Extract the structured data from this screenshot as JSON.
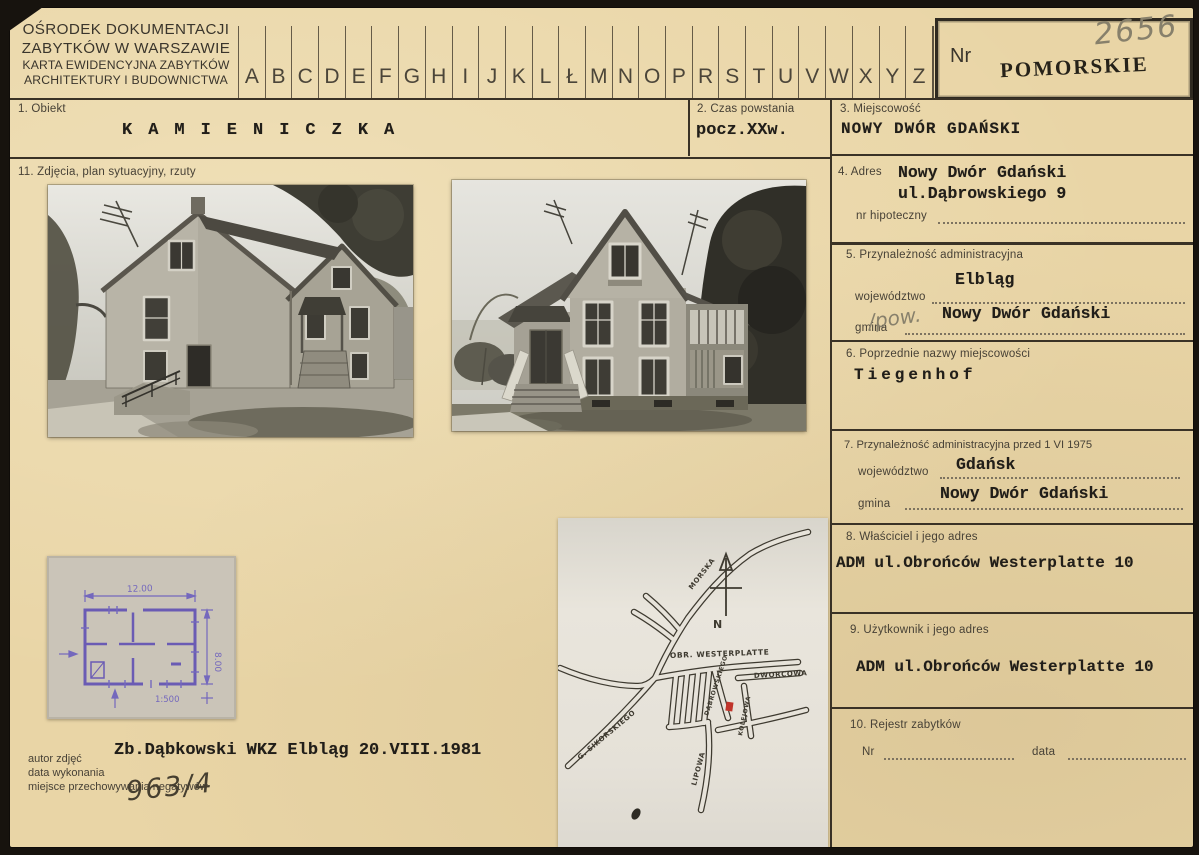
{
  "colors": {
    "paper": "#e9d5a6",
    "backdrop": "#17130e",
    "typed_ink": "#211e19",
    "label_ink": "#474136",
    "pencil": "#87806b",
    "handwriting_ink": "#463f30",
    "blueprint_ink": "#6a5bb4",
    "map_marker": "#c0342a",
    "stamp_ink": "#262219"
  },
  "header": {
    "org_lines": [
      "OŚRODEK DOKUMENTACJI",
      "ZABYTKÓW W WARSZAWIE",
      "KARTA EWIDENCYJNA ZABYTKÓW",
      "ARCHITEKTURY I BUDOWNICTWA"
    ],
    "alphabet": [
      "A",
      "B",
      "C",
      "D",
      "E",
      "F",
      "G",
      "H",
      "I",
      "J",
      "K",
      "L",
      "Ł",
      "M",
      "N",
      "O",
      "P",
      "R",
      "S",
      "T",
      "U",
      "V",
      "W",
      "X",
      "Y",
      "Z"
    ],
    "nr_label": "Nr",
    "nr_value": "2656",
    "region_stamp": "POMORSKIE"
  },
  "fields": {
    "obiekt": {
      "label": "1. Obiekt",
      "value": "KAMIENICZKA"
    },
    "czas": {
      "label": "2. Czas powstania",
      "value": "pocz.XXw."
    },
    "miejscowosc": {
      "label": "3. Miejscowość",
      "value": "NOWY DWÓR GDAŃSKI"
    },
    "adres": {
      "label": "4. Adres",
      "line1": "Nowy Dwór Gdański",
      "line2": "ul.Dąbrowskiego 9",
      "hipoteczny_label": "nr hipoteczny"
    },
    "admin": {
      "label": "5. Przynależność administracyjna",
      "woj_label": "województwo",
      "woj_value": "Elbląg",
      "gmina_label": "gmina",
      "gmina_note": "/pow.",
      "gmina_value": "Nowy Dwór Gdański"
    },
    "poprzednie": {
      "label": "6. Poprzednie nazwy miejscowości",
      "value": "Tiegenhof"
    },
    "admin1975": {
      "label": "7. Przynależność administracyjna przed 1 VI 1975",
      "woj_label": "województwo",
      "woj_value": "Gdańsk",
      "gmina_label": "gmina",
      "gmina_value": "Nowy Dwór Gdański"
    },
    "wlasciciel": {
      "label": "8. Właściciel i jego adres",
      "value": "ADM ul.Obrońców Westerplatte 10"
    },
    "uzytkownik": {
      "label": "9. Użytkownik i jego adres",
      "value": "ADM ul.Obrońców Westerplatte 10"
    },
    "rejestr": {
      "label": "10. Rejestr zabytków",
      "nr_label": "Nr",
      "data_label": "data"
    },
    "zdjecia": {
      "label": "11. Zdjęcia, plan sytuacyjny, rzuty"
    }
  },
  "footer": {
    "labels": [
      "autor zdjęć",
      "data wykonania",
      "miejsce przechowywania negatywów"
    ],
    "typed": "Zb.Dąbkowski WKZ Elbląg 20.VIII.1981",
    "negative_no": "963/4"
  },
  "plan": {
    "width_dim": "12.00",
    "height_dim": "8.00",
    "scale": "1:500"
  },
  "map": {
    "north": "N",
    "streets": {
      "morska": "MORSKA",
      "westerplatte": "OBR. WESTERPLATTE",
      "dabrowskiego": "DĄBROWSKIEGO",
      "dworcowa": "DWORCOWA",
      "kolejowa": "KOLEJOWA",
      "lipowa": "LIPOWA",
      "sikorskiego": "G. SIKORSKIEGO"
    }
  }
}
